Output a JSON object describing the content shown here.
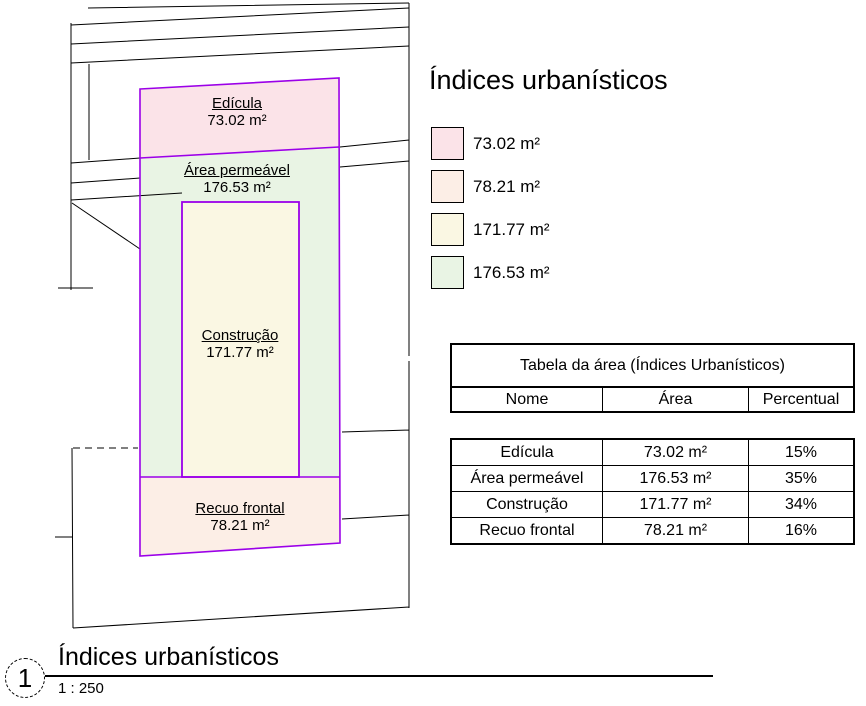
{
  "colors": {
    "pink": "#FBE3E8",
    "peach": "#FCEEE6",
    "cream": "#FAF7E3",
    "green": "#E9F4E4",
    "purple": "#9B00E8",
    "line": "#000000"
  },
  "plan": {
    "regions": [
      {
        "name": "Edícula",
        "area": "73.02 m²"
      },
      {
        "name": "Área permeável",
        "area": "176.53 m²"
      },
      {
        "name": "Construção",
        "area": "171.77 m²"
      },
      {
        "name": "Recuo frontal",
        "area": "78.21 m²"
      }
    ]
  },
  "legend": {
    "title": "Índices urbanísticos",
    "items": [
      {
        "area": "73.02 m²"
      },
      {
        "area": "78.21 m²"
      },
      {
        "area": "171.77 m²"
      },
      {
        "area": "176.53 m²"
      }
    ]
  },
  "table": {
    "title": "Tabela da área (Índices Urbanísticos)",
    "columns": [
      "Nome",
      "Área",
      "Percentual"
    ],
    "rows": [
      {
        "nome": "Edícula",
        "area": "73.02 m²",
        "percentual": "15%"
      },
      {
        "nome": "Área permeável",
        "area": "176.53 m²",
        "percentual": "35%"
      },
      {
        "nome": "Construção",
        "area": "171.77 m²",
        "percentual": "34%"
      },
      {
        "nome": "Recuo frontal",
        "area": "78.21 m²",
        "percentual": "16%"
      }
    ]
  },
  "view_title": {
    "number": "1",
    "title": "Índices urbanísticos",
    "scale": "1 : 250"
  }
}
